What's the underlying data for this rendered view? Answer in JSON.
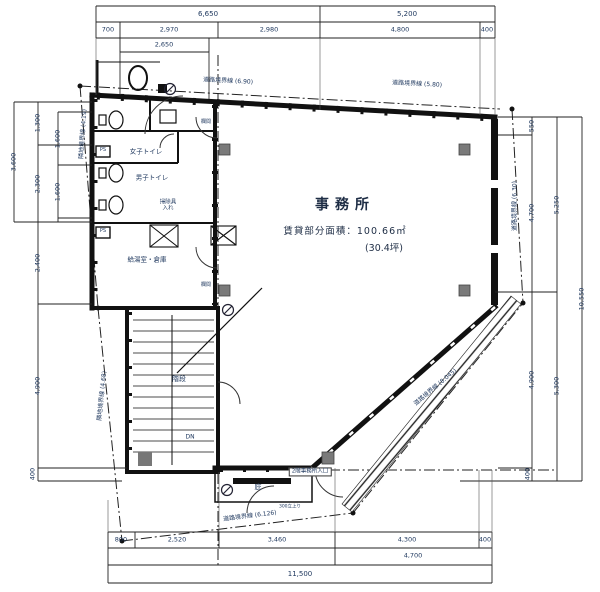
{
  "colors": {
    "background": "#ffffff",
    "line": "#1b1b1b",
    "wall": "#111111",
    "dim_text": "#20395f",
    "column_gray": "#7a7a7a"
  },
  "office": {
    "title": "事務所",
    "area": "賃貸部分面積：100.66㎡",
    "tsubo": "(30.4坪)"
  },
  "labels": [
    {
      "name": "dim-top-total-left",
      "text": "6,650",
      "x": 208,
      "y": 14,
      "rot": 0,
      "size": 7
    },
    {
      "name": "dim-top-total-right",
      "text": "5,200",
      "x": 407,
      "y": 14,
      "rot": 0,
      "size": 7
    },
    {
      "name": "dim-top-700",
      "text": "700",
      "x": 108,
      "y": 30,
      "rot": 0,
      "size": 6.5
    },
    {
      "name": "dim-top-2970",
      "text": "2,970",
      "x": 169,
      "y": 30,
      "rot": 0,
      "size": 6.5
    },
    {
      "name": "dim-top-2980",
      "text": "2,980",
      "x": 269,
      "y": 30,
      "rot": 0,
      "size": 6.5
    },
    {
      "name": "dim-top-4800",
      "text": "4,800",
      "x": 400,
      "y": 30,
      "rot": 0,
      "size": 6.5
    },
    {
      "name": "dim-top-400",
      "text": "400",
      "x": 487,
      "y": 30,
      "rot": 0,
      "size": 6.5
    },
    {
      "name": "dim-top-2650",
      "text": "2,650",
      "x": 164,
      "y": 45,
      "rot": 0,
      "size": 6.5
    },
    {
      "name": "dim-bottom-800",
      "text": "800",
      "x": 121,
      "y": 540,
      "rot": 0,
      "size": 6.5
    },
    {
      "name": "dim-bottom-2520",
      "text": "2,520",
      "x": 177,
      "y": 540,
      "rot": 0,
      "size": 6.5
    },
    {
      "name": "dim-bottom-3460",
      "text": "3,460",
      "x": 277,
      "y": 540,
      "rot": 0,
      "size": 6.5
    },
    {
      "name": "dim-bottom-4300",
      "text": "4,300",
      "x": 407,
      "y": 540,
      "rot": 0,
      "size": 6.5
    },
    {
      "name": "dim-bottom-400",
      "text": "400",
      "x": 485,
      "y": 540,
      "rot": 0,
      "size": 6.5
    },
    {
      "name": "dim-bottom-4700",
      "text": "4,700",
      "x": 413,
      "y": 556,
      "rot": 0,
      "size": 6.5
    },
    {
      "name": "dim-bottom-11500",
      "text": "11,500",
      "x": 300,
      "y": 574,
      "rot": 0,
      "size": 7
    },
    {
      "name": "dim-left-3600",
      "text": "3,600",
      "x": 14,
      "y": 162,
      "rot": -90,
      "size": 6.5
    },
    {
      "name": "dim-left-1300",
      "text": "1,300",
      "x": 38,
      "y": 123,
      "rot": -90,
      "size": 6.5
    },
    {
      "name": "dim-left-2300",
      "text": "2,300",
      "x": 38,
      "y": 184,
      "rot": -90,
      "size": 6.5
    },
    {
      "name": "dim-left-1600-upper",
      "text": "1,600",
      "x": 58,
      "y": 139,
      "rot": -90,
      "size": 6.5
    },
    {
      "name": "dim-left-1600-lower",
      "text": "1,600",
      "x": 58,
      "y": 192,
      "rot": -90,
      "size": 6.5
    },
    {
      "name": "dim-left-2400",
      "text": "2,400",
      "x": 38,
      "y": 263,
      "rot": -90,
      "size": 6.5
    },
    {
      "name": "dim-left-4900",
      "text": "4,900",
      "x": 38,
      "y": 386,
      "rot": -90,
      "size": 6.5
    },
    {
      "name": "dim-left-400",
      "text": "400",
      "x": 33,
      "y": 474,
      "rot": -90,
      "size": 6.5
    },
    {
      "name": "dim-right-550",
      "text": "550",
      "x": 532,
      "y": 126,
      "rot": -90,
      "size": 6.5
    },
    {
      "name": "dim-right-4700",
      "text": "4,700",
      "x": 532,
      "y": 213,
      "rot": -90,
      "size": 6.5
    },
    {
      "name": "dim-right-4900",
      "text": "4,900",
      "x": 532,
      "y": 380,
      "rot": -90,
      "size": 6.5
    },
    {
      "name": "dim-right-400",
      "text": "400",
      "x": 528,
      "y": 474,
      "rot": -90,
      "size": 6.5
    },
    {
      "name": "dim-right-5250",
      "text": "5,250",
      "x": 557,
      "y": 205,
      "rot": -90,
      "size": 6.5
    },
    {
      "name": "dim-right-5300",
      "text": "5,300",
      "x": 557,
      "y": 386,
      "rot": -90,
      "size": 6.5
    },
    {
      "name": "dim-right-10550",
      "text": "10,550",
      "x": 582,
      "y": 299,
      "rot": -90,
      "size": 6.5
    },
    {
      "name": "boundary-road-top-left",
      "text": "道路境界線 (6.90)",
      "x": 228,
      "y": 82,
      "rot": 3,
      "size": 6
    },
    {
      "name": "boundary-road-top-right",
      "text": "道路境界線 (5.80)",
      "x": 417,
      "y": 85,
      "rot": 3,
      "size": 6
    },
    {
      "name": "boundary-adjacent-left-upper",
      "text": "隣地境界線 (4.19)",
      "x": 84,
      "y": 134,
      "rot": -86,
      "size": 6
    },
    {
      "name": "boundary-adjacent-left-lower",
      "text": "隣地境界線 (4.68)",
      "x": 103,
      "y": 396,
      "rot": -84,
      "size": 6
    },
    {
      "name": "boundary-road-right",
      "text": "道路境界線 (6.30)",
      "x": 516,
      "y": 206,
      "rot": -90,
      "size": 6
    },
    {
      "name": "boundary-road-diagonal",
      "text": "道路境界線 (8.045)",
      "x": 436,
      "y": 388,
      "rot": -40,
      "size": 6
    },
    {
      "name": "boundary-road-bottom",
      "text": "道路境界線 (6.126)",
      "x": 250,
      "y": 517,
      "rot": -7,
      "size": 6
    },
    {
      "name": "room-womens-toilet",
      "text": "女子トイレ",
      "x": 146,
      "y": 152,
      "rot": 0,
      "size": 6.5
    },
    {
      "name": "room-mens-toilet",
      "text": "男子トイレ",
      "x": 152,
      "y": 178,
      "rot": 0,
      "size": 6.5
    },
    {
      "name": "room-cleaning-closet",
      "text": "掃除具\n入れ",
      "x": 168,
      "y": 206,
      "rot": 0,
      "size": 5.5
    },
    {
      "name": "room-kitchen-storage",
      "text": "給湯室・倉庫",
      "x": 147,
      "y": 260,
      "rot": 0,
      "size": 6.5
    },
    {
      "name": "room-stairs",
      "text": "階段",
      "x": 179,
      "y": 379,
      "rot": 0,
      "size": 7
    },
    {
      "name": "stairs-dn",
      "text": "DN",
      "x": 190,
      "y": 438,
      "rot": 0,
      "size": 6
    },
    {
      "name": "canopy",
      "text": "庇",
      "x": 258,
      "y": 487,
      "rot": 0,
      "size": 7
    },
    {
      "name": "entrance-label",
      "text": "2階事務所入口",
      "x": 310,
      "y": 472,
      "rot": 0,
      "size": 5.5,
      "boxed": true
    },
    {
      "name": "ps-upper",
      "text": "PS",
      "x": 103,
      "y": 151,
      "rot": 0,
      "size": 5
    },
    {
      "name": "ps-lower",
      "text": "PS",
      "x": 103,
      "y": 232,
      "rot": 0,
      "size": 5
    },
    {
      "name": "transom-upper",
      "text": "欄間",
      "x": 206,
      "y": 123,
      "rot": 0,
      "size": 5
    },
    {
      "name": "transom-lower",
      "text": "欄間",
      "x": 206,
      "y": 286,
      "rot": 0,
      "size": 5
    },
    {
      "name": "note-upstand",
      "text": "300立上り",
      "x": 290,
      "y": 507,
      "rot": 0,
      "size": 4.5
    }
  ]
}
